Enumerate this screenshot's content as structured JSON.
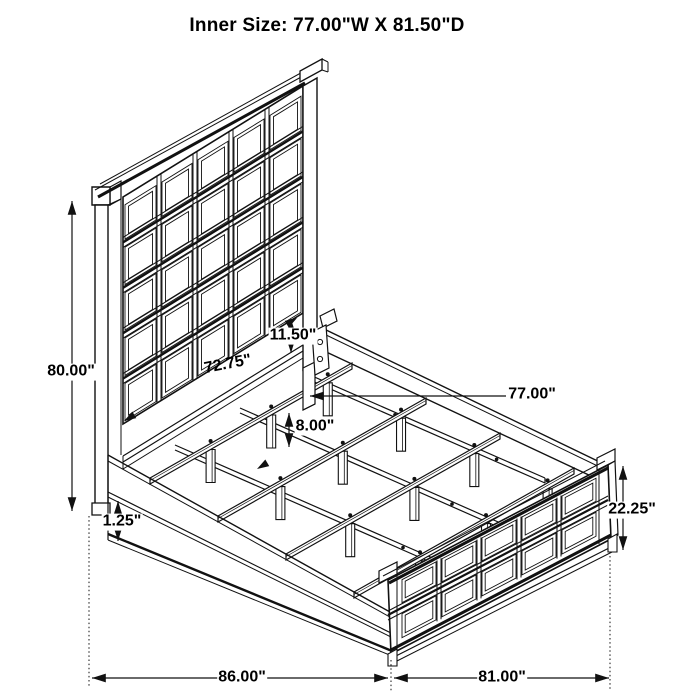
{
  "title": "Inner Size: 77.00\"W X 81.50\"D",
  "inner_size": {
    "width": "77.00\"W",
    "depth": "81.50\"D"
  },
  "dimensions": {
    "overall_height": {
      "label": "80.00\""
    },
    "headboard_width": {
      "label": "72.75\""
    },
    "headboard_rail_gap": {
      "label": "11.50\""
    },
    "inner_width": {
      "label": "77.00\""
    },
    "support_leg_height": {
      "label": "8.00\""
    },
    "rail_lip": {
      "label": "1.25\""
    },
    "footboard_height": {
      "label": "22.25\""
    },
    "overall_depth": {
      "label": "86.00\""
    },
    "overall_width": {
      "label": "81.00\""
    }
  },
  "colors": {
    "line": "#111111",
    "background": "#ffffff"
  }
}
